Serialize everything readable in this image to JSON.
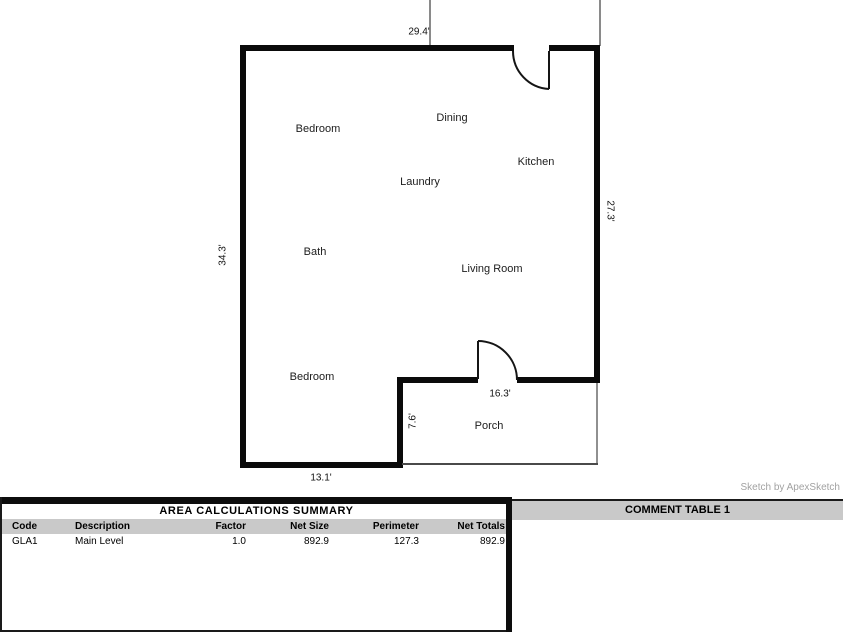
{
  "plan": {
    "rooms": [
      {
        "label": "Bedroom"
      },
      {
        "label": "Dining"
      },
      {
        "label": "Kitchen"
      },
      {
        "label": "Laundry"
      },
      {
        "label": "Bath"
      },
      {
        "label": "Living Room"
      },
      {
        "label": "Bedroom"
      },
      {
        "label": "Porch"
      }
    ],
    "dimensions": [
      {
        "label": "29.4'"
      },
      {
        "label": "34.3'"
      },
      {
        "label": "27.3'"
      },
      {
        "label": "7.6'"
      },
      {
        "label": "16.3'"
      },
      {
        "label": "13.1'"
      }
    ],
    "credit": "Sketch by ApexSketch"
  },
  "area_table": {
    "title": "AREA CALCULATIONS SUMMARY",
    "columns": [
      "Code",
      "Description",
      "Factor",
      "Net Size",
      "Perimeter",
      "Net Totals"
    ],
    "rows": [
      [
        "GLA1",
        "Main Level",
        "1.0",
        "892.9",
        "127.3",
        "892.9"
      ]
    ]
  },
  "comment_table": {
    "title": "COMMENT TABLE 1"
  },
  "colors": {
    "wall": "#0a0a0a",
    "extension_line": "#8a8a8a",
    "porch_outline": "#909090",
    "header_strip": "#c9c9c9",
    "credit_text": "#a2a2a2"
  }
}
